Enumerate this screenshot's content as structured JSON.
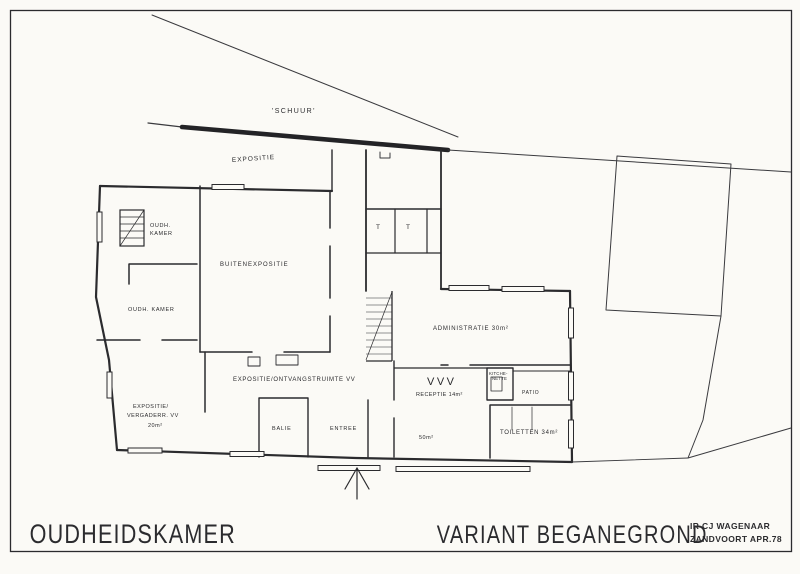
{
  "titleblock": {
    "project_title": "OUDHEIDSKAMER",
    "drawing_title": "VARIANT BEGANEGROND",
    "architect": "IR CJ WAGENAAR",
    "place_date": "ZANDVOORT APR.78"
  },
  "site": {
    "shed_label": "'SCHUUR'",
    "outdoor_exposition_label": "EXPOSITIE"
  },
  "rooms": {
    "oudh_kamer_upper_line1": "OUDH.",
    "oudh_kamer_upper_line2": "KAMER",
    "oudh_kamer_lower": "OUDH. KAMER",
    "buitenexpositie": "BUITENEXPOSITIE",
    "expositie_ontvangstruimte": "EXPOSITIE/ONTVANGSTRUIMTE VV",
    "expositie_vergader_line1": "EXPOSITIE/",
    "expositie_vergader_line2": "VERGADERR. VV",
    "expositie_vergader_line3": "20m²",
    "balie": "BALIE",
    "entree": "ENTREE",
    "vvv": "VVV",
    "receptie": "RECEPTIE 14m²",
    "kitchenette_line1": "KITCHE-",
    "kitchenette_line2": "NETTE",
    "patio": "PATIO",
    "administratie": "ADMINISTRATIE 30m²",
    "hall_area": "50m²",
    "toiletten": "TOILETTEN 34m²",
    "toilet_cell_1": "T",
    "toilet_cell_2": "T"
  },
  "colors": {
    "ink": "#2b2b2e",
    "paper": "#fbfaf6"
  }
}
